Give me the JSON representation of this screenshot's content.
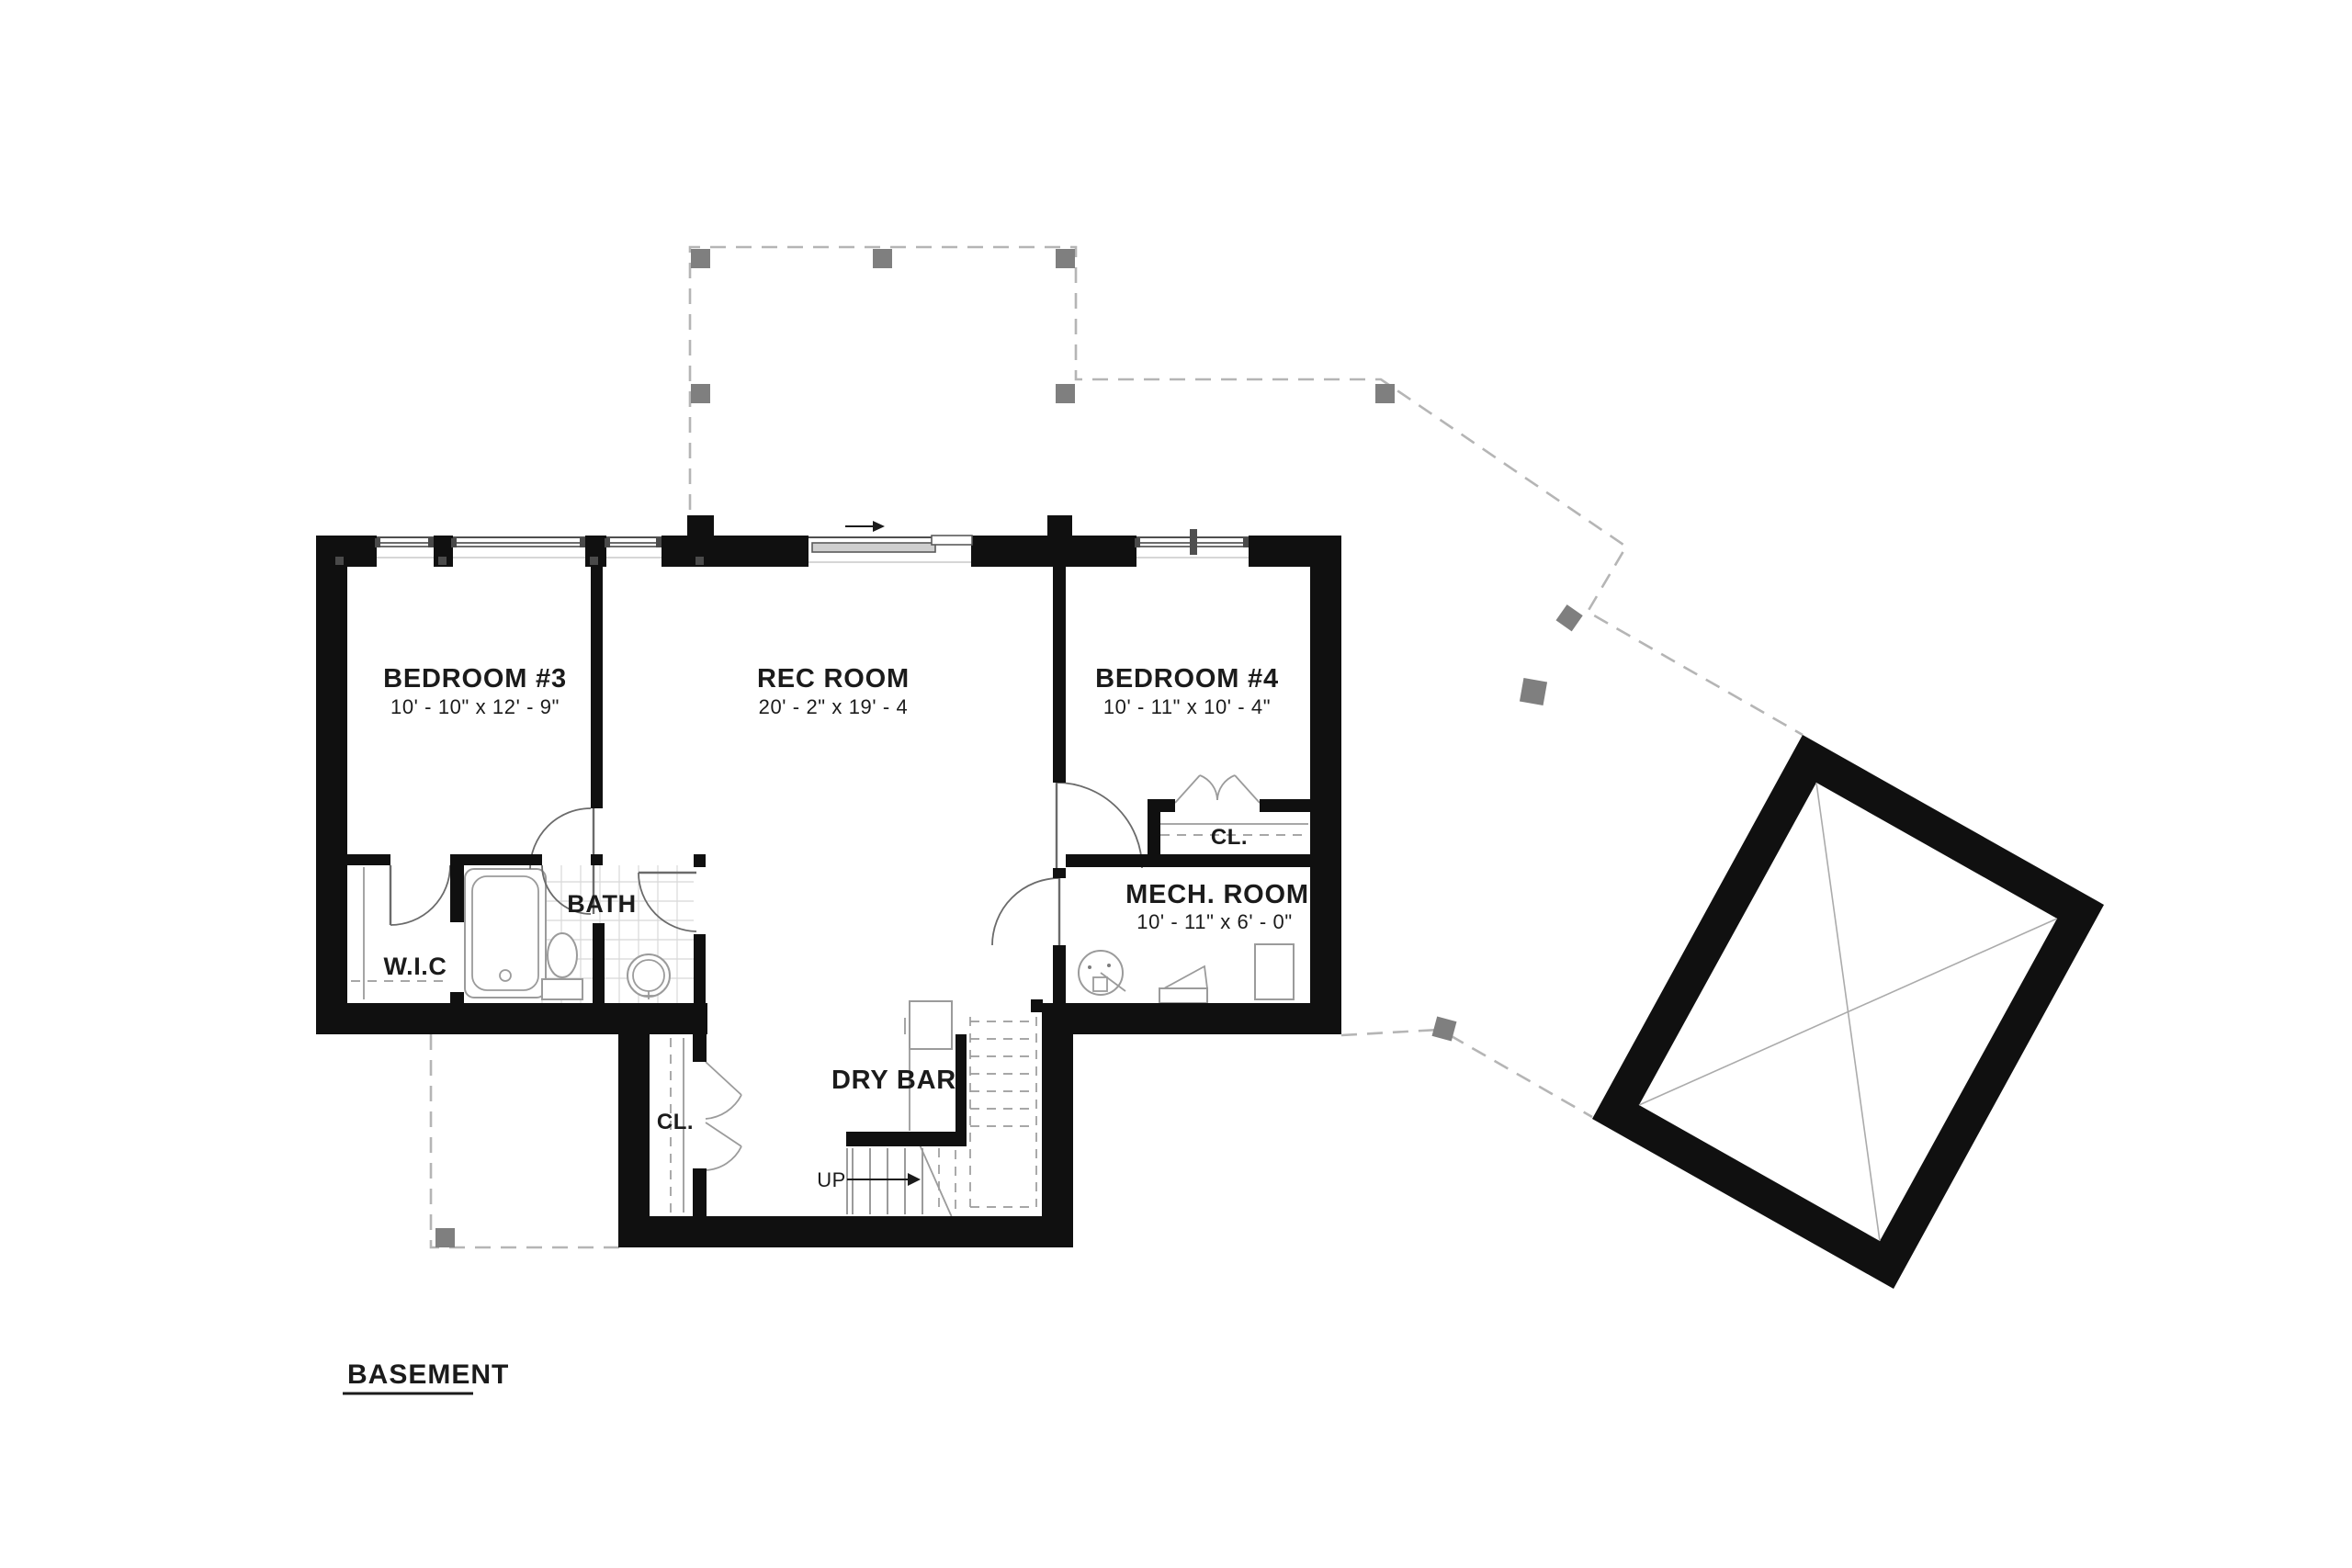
{
  "title": {
    "label": "BASEMENT"
  },
  "rooms": {
    "bedroom3": {
      "name": "BEDROOM #3",
      "dims": "10' - 10\" x 12' - 9\""
    },
    "rec_room": {
      "name": "REC ROOM",
      "dims": "20' - 2\" x 19' - 4"
    },
    "bedroom4": {
      "name": "BEDROOM #4",
      "dims": "10' - 11\" x 10' - 4\""
    },
    "mech_room": {
      "name": "MECH. ROOM",
      "dims": "10' - 11\" x 6' - 0\""
    },
    "bath": {
      "name": "BATH"
    },
    "wic": {
      "name": "W.I.C"
    },
    "closet_bedroom4": {
      "name": "CL."
    },
    "closet_hall": {
      "name": "CL."
    },
    "dry_bar": {
      "name": "DRY BAR"
    },
    "stairs": {
      "name": "UP"
    }
  },
  "colors": {
    "wall": "#101010",
    "post": "#7f7f7f",
    "dashline": "#b5b5b5",
    "fixline": "#9b9b9b",
    "doorline": "#6b6b6b",
    "tile": "#d8d8d8",
    "ink": "#1b1b1b"
  }
}
